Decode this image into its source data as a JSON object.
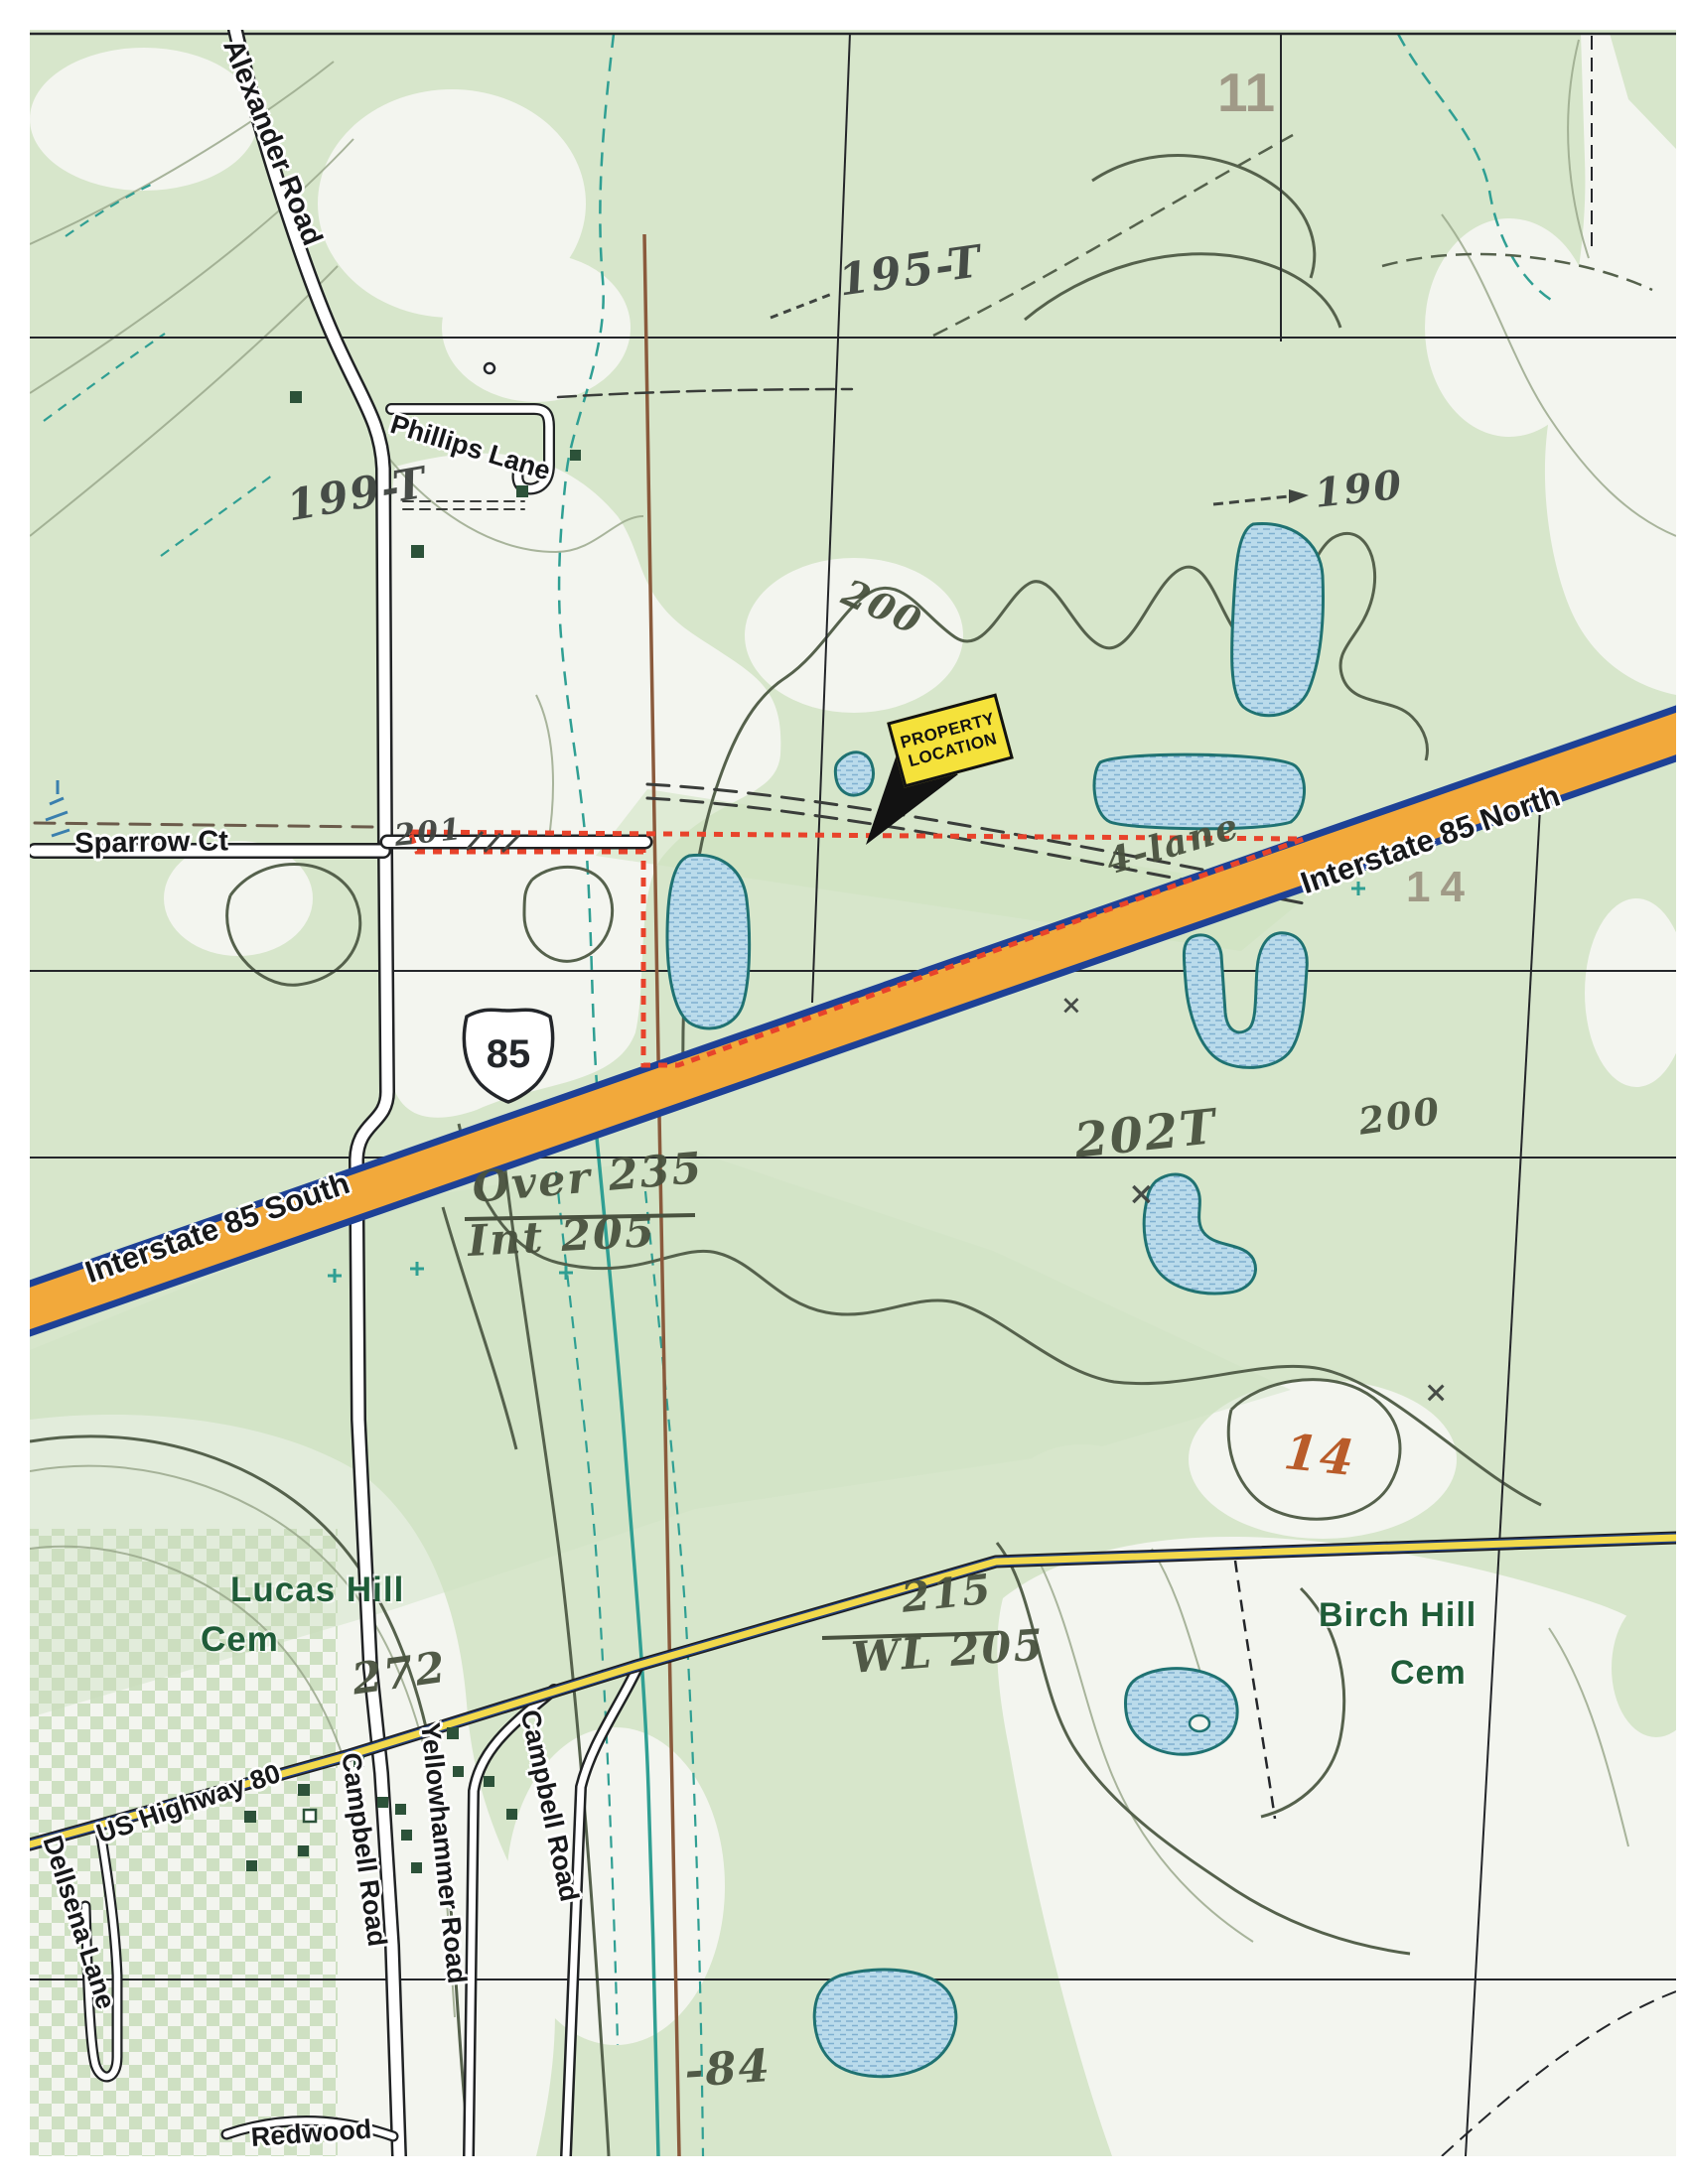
{
  "document": {
    "type": "scanned USGS-style topographic map with property location markup"
  },
  "callout": {
    "line1": "PROPERTY",
    "line2": "LOCATION"
  },
  "roads": {
    "alexander_road": "Alexander Road",
    "phillips_lane": "Phillips Lane",
    "sparrow_ct": "Sparrow Ct",
    "interstate_85_north": "Interstate 85 North",
    "interstate_85_south": "Interstate 85 South",
    "us_highway_80": "US Highway 80",
    "campbell_road_west": "Campbell Road",
    "campbell_road_east": "Campbell Road",
    "yellowhammer_road": "Yellowhammer Road",
    "dellsena_lane": "Dellsena Lane",
    "redwood": "Redwood",
    "interstate_shield": "85"
  },
  "places": {
    "lucas_hill_cem": {
      "line1": "Lucas Hill",
      "line2": "Cem"
    },
    "birch_hill_cem": {
      "line1": "Birch Hill",
      "line2": "Cem"
    }
  },
  "section_numbers": {
    "north": "11",
    "east": "14"
  },
  "annotations": {
    "elev_195t": "195-T",
    "elev_199t": "199-T",
    "elev_190": "190",
    "contour_200_upper": "200",
    "contour_200_right": "200",
    "elev_202t": "202T",
    "parcel_201": "201",
    "four_lane": "4-lane",
    "over_clearance": "Over 235",
    "int_clearance": "Int 205",
    "elev_272": "272",
    "elev_215": "215",
    "water_level_205": "WL 205",
    "section_14_handwritten": "14",
    "elev_84": "-84",
    "x_mark": "×"
  },
  "colors": {
    "interstate_orange": "#f2a93b",
    "interstate_edge": "#1e4196",
    "highway_yellow": "#f2d94c",
    "highway_edge": "#223e7c",
    "boundary_red": "#e8432b",
    "pond_fill": "#badbeb",
    "pond_hatch": "#7fb0d0",
    "pond_edge": "#1f7272",
    "veg_green": "#d7e6cb",
    "land_white": "#f3f5ef",
    "contour_dark": "#55614c",
    "contour_light": "#9aa88c",
    "creek_teal": "#2f9f93",
    "cemetery_checker": "#c8dcba",
    "cemetery_green": "#1f5c38",
    "building_green": "#2c5239",
    "grid_gray": "#9b9280",
    "pipeline_brown": "#8a5a3c",
    "handwriting": "#49523f",
    "handwriting_orange": "#b65420",
    "callout_yellow": "#f5e23b"
  }
}
